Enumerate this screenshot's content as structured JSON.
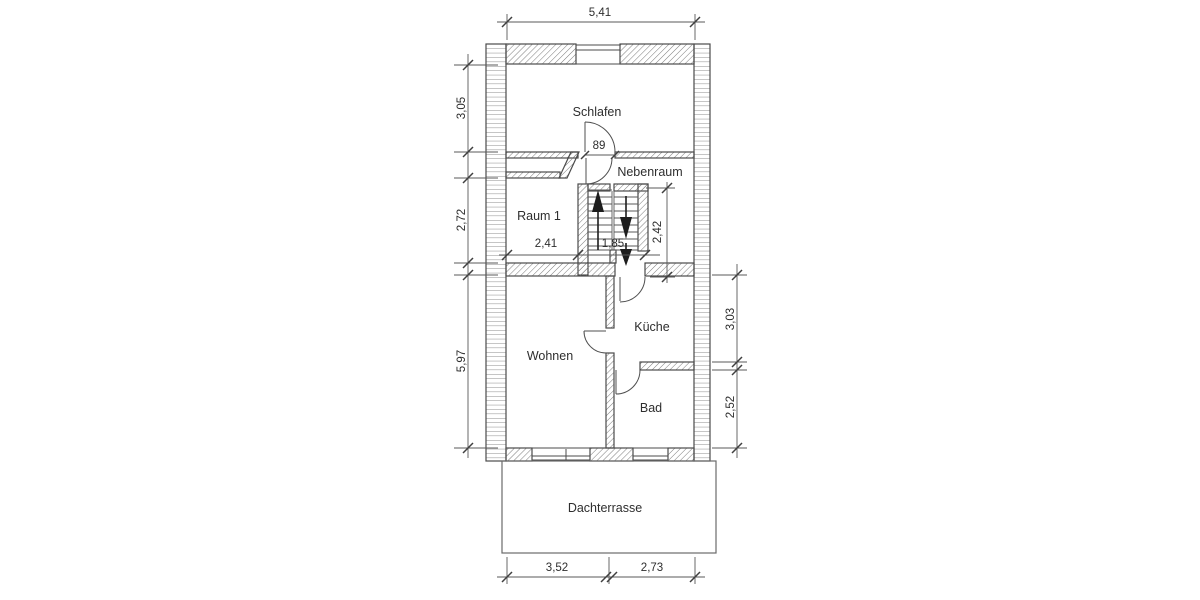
{
  "drawing": {
    "type": "floor-plan",
    "rooms": {
      "schlafen": "Schlafen",
      "nebenraum": "Nebenraum",
      "raum1": "Raum 1",
      "wohnen": "Wohnen",
      "kueche": "Küche",
      "bad": "Bad",
      "dachterrasse": "Dachterrasse"
    },
    "dimensions": {
      "overall_width": "5,41",
      "schlafen_depth": "3,05",
      "raum1_depth": "2,72",
      "wohnen_depth": "5,97",
      "kueche_depth": "3,03",
      "bad_depth": "2,52",
      "stair_depth": "2,42",
      "raum1_width": "2,41",
      "stair_width": "1,85",
      "door_width": "89",
      "terrace_width_left": "3,52",
      "terrace_width_right": "2,73"
    },
    "colors": {
      "background": "#ffffff",
      "wall_line": "#4b4b4b",
      "hatch_line": "#7a7a7a",
      "dimension_line": "#585858",
      "text": "#2e2e2e"
    }
  }
}
